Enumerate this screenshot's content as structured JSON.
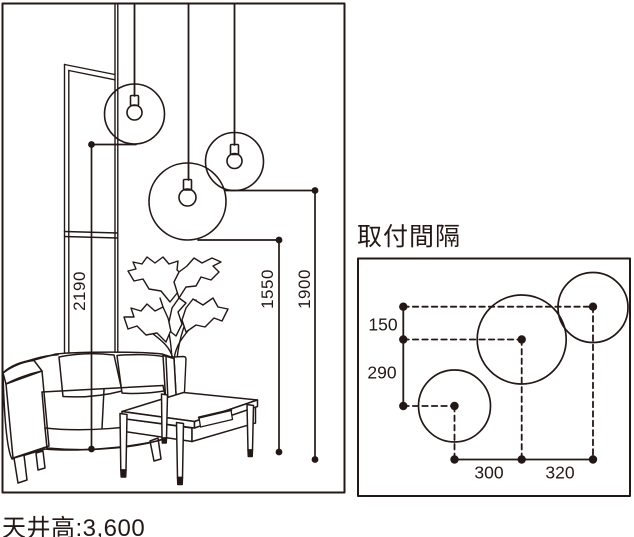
{
  "figure": {
    "ceiling_label": "天井高:3,600",
    "drops": [
      {
        "pendant": "left-pendant",
        "value": "2190"
      },
      {
        "pendant": "middle-pendant",
        "value": "1550"
      },
      {
        "pendant": "right-pendant",
        "value": "1900"
      }
    ],
    "spacing": {
      "title": "取付間隔",
      "v_gaps": [
        "150",
        "290"
      ],
      "h_gaps": [
        "300",
        "320"
      ]
    },
    "colors": {
      "line": "#231815",
      "background": "#ffffff"
    }
  }
}
